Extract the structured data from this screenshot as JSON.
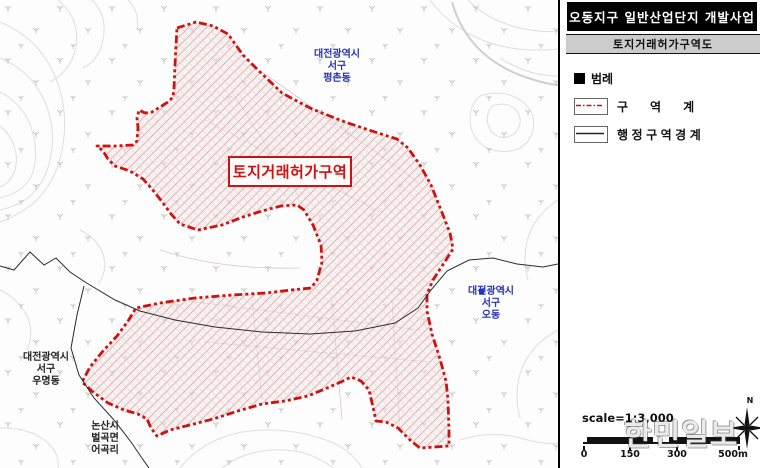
{
  "panel": {
    "title": "오동지구 일반산업단지 개발사업",
    "subtitle": "토지거래허가구역도",
    "legend": {
      "heading": "범례",
      "items": [
        {
          "label": "구역계",
          "type": "zone-boundary"
        },
        {
          "label": "행정구역경계",
          "type": "admin-boundary"
        }
      ]
    },
    "scale": {
      "text": "scale=1:3,000",
      "ticks": [
        "0",
        "150",
        "300",
        "500m"
      ]
    },
    "north_label": "N"
  },
  "map": {
    "zone_label": "토지거래허가구역",
    "area_labels": [
      {
        "lines": [
          "대전광역시",
          "서구",
          "평촌동"
        ],
        "color": "blue"
      },
      {
        "lines": [
          "대전광역시",
          "서구",
          "오동"
        ],
        "color": "blue"
      },
      {
        "lines": [
          "대전광역시",
          "서구",
          "우명동"
        ],
        "color": "black"
      },
      {
        "lines": [
          "논산시",
          "벌곡면",
          "어곡리"
        ],
        "color": "black"
      }
    ]
  },
  "watermark": "한민일보",
  "colors": {
    "boundary_red": "#d01111",
    "label_blue": "#2733b4",
    "admin_line": "#2b2b2b",
    "contour_gray": "#dedede"
  }
}
